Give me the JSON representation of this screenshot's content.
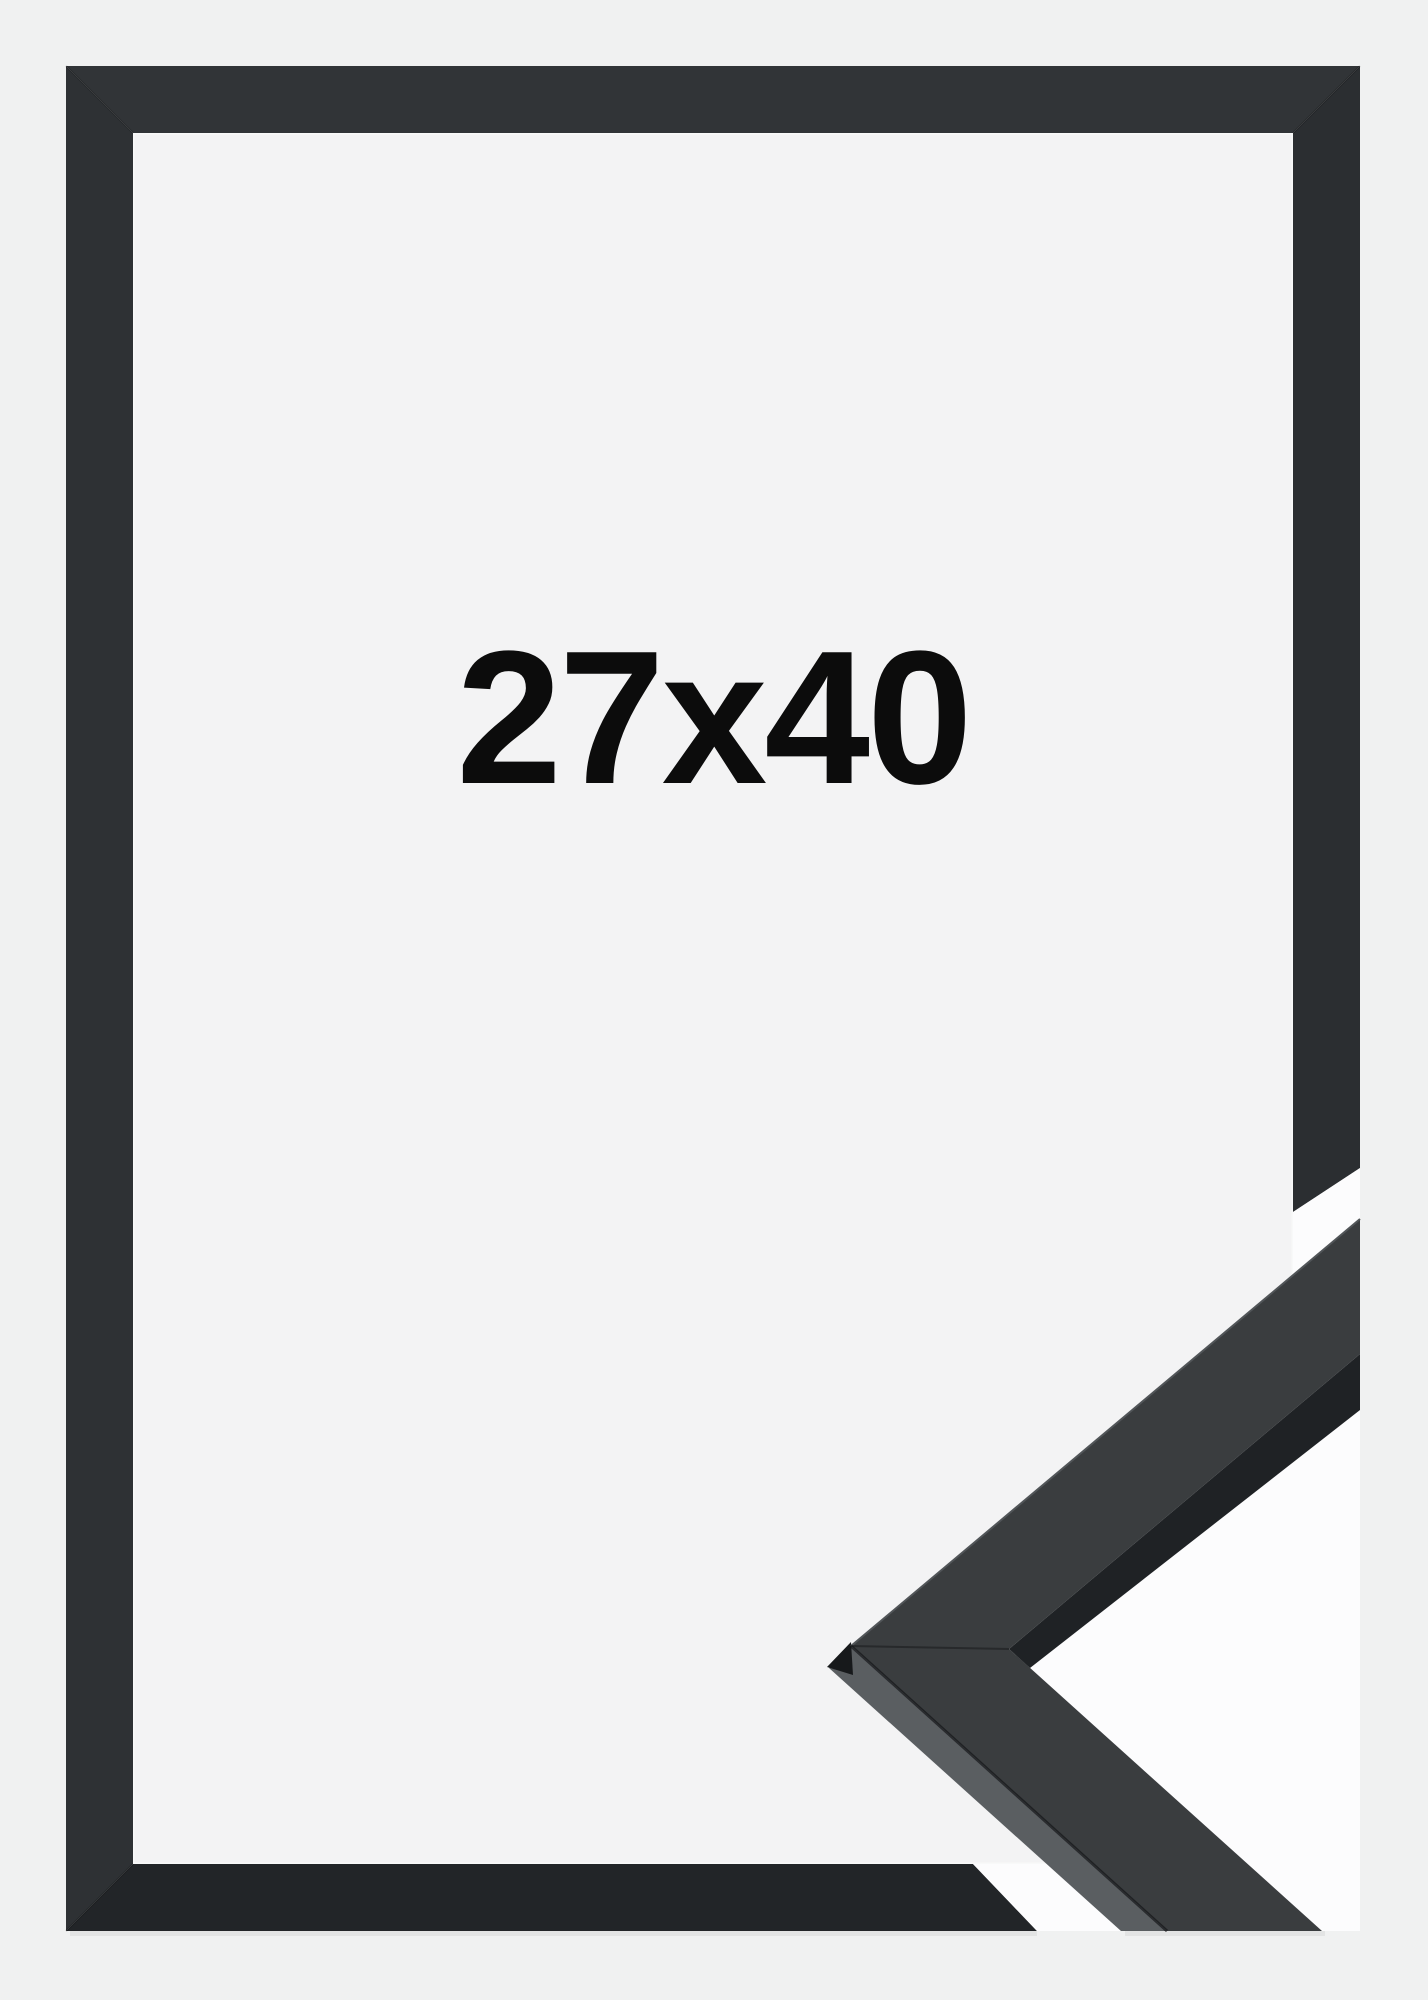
{
  "size_label": {
    "text": "27x40"
  },
  "product_photo": {
    "subject": "black picture frame with corner moulding sample",
    "frame_outer_box": {
      "left": 66,
      "top": 66,
      "right": 1360,
      "bottom": 1931
    },
    "frame_rail_thickness": 67
  },
  "colors": {
    "bg": "#f0f1f1",
    "interior": "#f3f3f4",
    "interior_highlight": "#f8f9f9",
    "rail_top": "#313437",
    "rail_left": "#2e3134",
    "rail_right": "#2b2e31",
    "rail_bottom": "#222528",
    "gap_white": "#fcfcfd",
    "sample_face": "#3a3d3f",
    "sample_side_dark": "#1f2225",
    "sample_bevel": "#5a5e61",
    "sample_tip": "#17191b",
    "sample_edge_highlight": "#515558",
    "seam": "#141618",
    "label_color": "#0c0c0c"
  }
}
